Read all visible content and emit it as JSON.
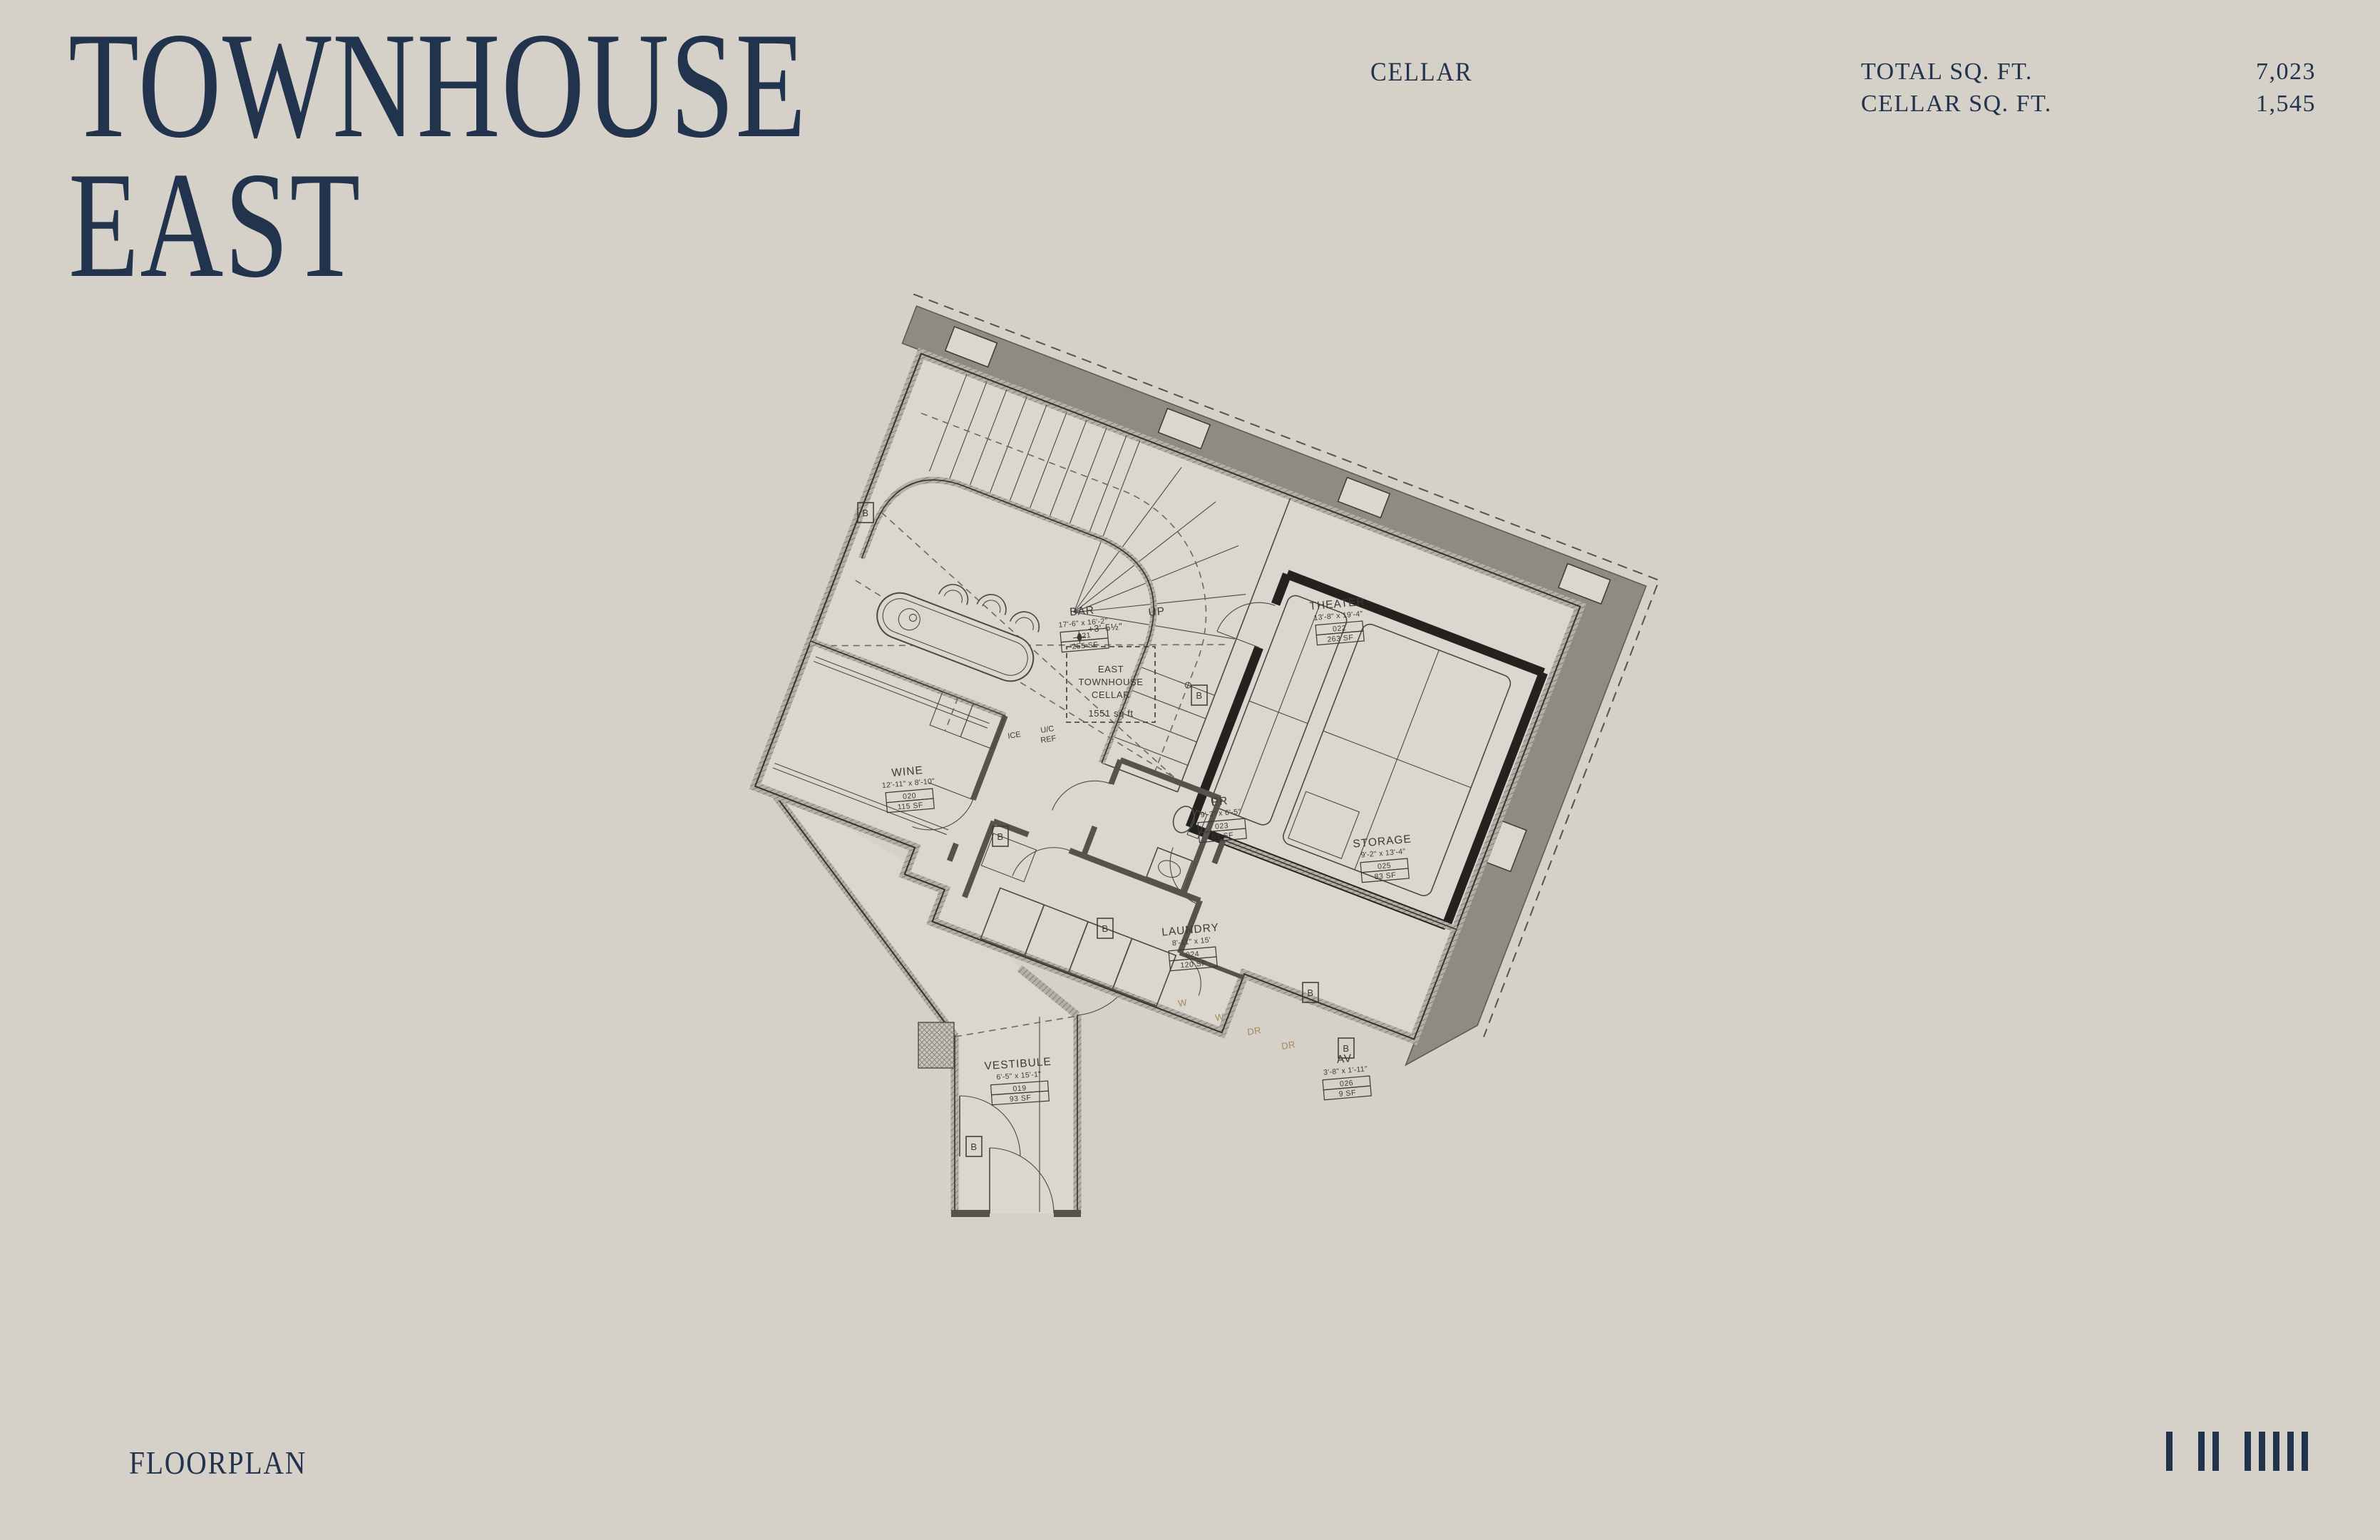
{
  "page": {
    "background": "#d5d0c8",
    "accent_navy": "#21334d",
    "band_gray": "#8e8b83"
  },
  "header": {
    "title_line1": "TOWNHOUSE",
    "title_line2": "EAST",
    "floor_label": "CELLAR",
    "stats": [
      {
        "label": "TOTAL SQ. FT.",
        "value": "7,023"
      },
      {
        "label": "CELLAR SQ. FT.",
        "value": "1,545"
      }
    ]
  },
  "footer": {
    "label": "FLOORPLAN",
    "floor_ticks": [
      1,
      2,
      5
    ]
  },
  "floorplan": {
    "unit_label": {
      "line1": "EAST",
      "line2": "TOWNHOUSE",
      "line3": "CELLAR",
      "area": "1551 sq ft"
    },
    "elevation_marker": "+3'-5½\"",
    "stair_label": "UP",
    "door_tag": "B",
    "fixtures": {
      "ice": "ICE",
      "uc": "U/C",
      "ref": "REF"
    },
    "appliances": [
      "W",
      "W",
      "DR",
      "DR"
    ],
    "rooms": [
      {
        "name": "BAR",
        "dims": "17'-6\" x 16'-2\"",
        "number": "021",
        "area": "255 SF"
      },
      {
        "name": "WINE",
        "dims": "12'-11\" x 8'-10\"",
        "number": "020",
        "area": "115 SF"
      },
      {
        "name": "THEATER",
        "dims": "13'-8\" x 19'-4\"",
        "number": "022",
        "area": "263 SF"
      },
      {
        "name": "PR",
        "dims": "9'-3\" x 6'-5\"",
        "number": "023",
        "area": "51 SF"
      },
      {
        "name": "STORAGE",
        "dims": "9'-2\" x 13'-4\"",
        "number": "025",
        "area": "83 SF"
      },
      {
        "name": "LAUNDRY",
        "dims": "8'-11\" x 15'",
        "number": "024",
        "area": "120 SF"
      },
      {
        "name": "AV",
        "dims": "3'-8\" x 1'-11\"",
        "number": "026",
        "area": "9 SF"
      },
      {
        "name": "VESTIBULE",
        "dims": "6'-5\" x 15'-1\"",
        "number": "019",
        "area": "93 SF"
      }
    ]
  }
}
